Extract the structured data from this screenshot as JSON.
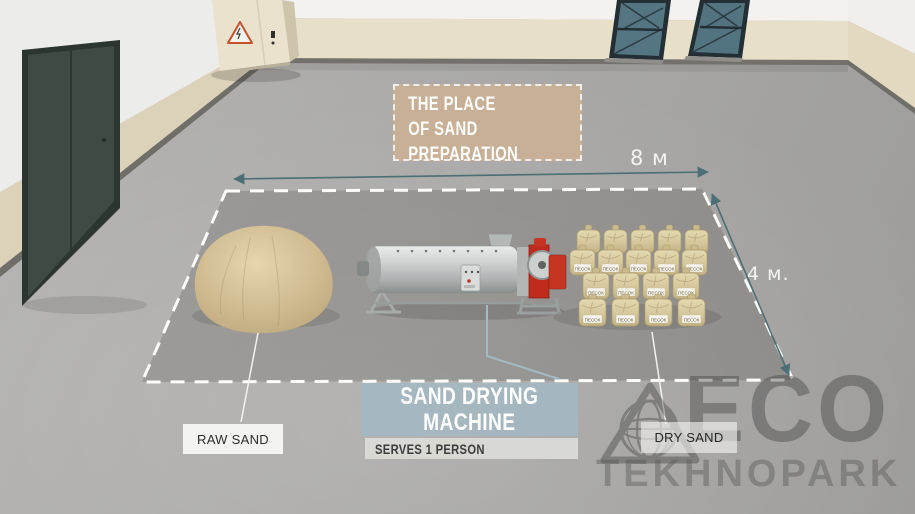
{
  "zone": {
    "title_lines": [
      "THE PLACE",
      "OF SAND",
      "PREPARATION"
    ],
    "width_label": "8 м",
    "depth_label": "4 м."
  },
  "callouts": {
    "raw_sand": "RAW SAND",
    "machine_title_lines": [
      "SAND DRYING",
      "MACHINE"
    ],
    "machine_subtitle": "SERVES 1 PERSON",
    "dry_sand": "DRY SAND"
  },
  "bags": {
    "label": "ПЕСОК"
  },
  "watermark": {
    "brand": "ECO",
    "subbrand": "TEKHNOPARK"
  },
  "colors": {
    "dimension_accent": "#4c6f75",
    "zone_border": "#ffffff",
    "place_label_bg": "#c8b093",
    "machine_label_bg": "#a3b7c2",
    "machine_red": "#bf2b1c",
    "sand": "#d5c098",
    "wall_beige": "#e8dfc8",
    "teal_door": "#547582",
    "dark_door": "#3f4a42"
  }
}
